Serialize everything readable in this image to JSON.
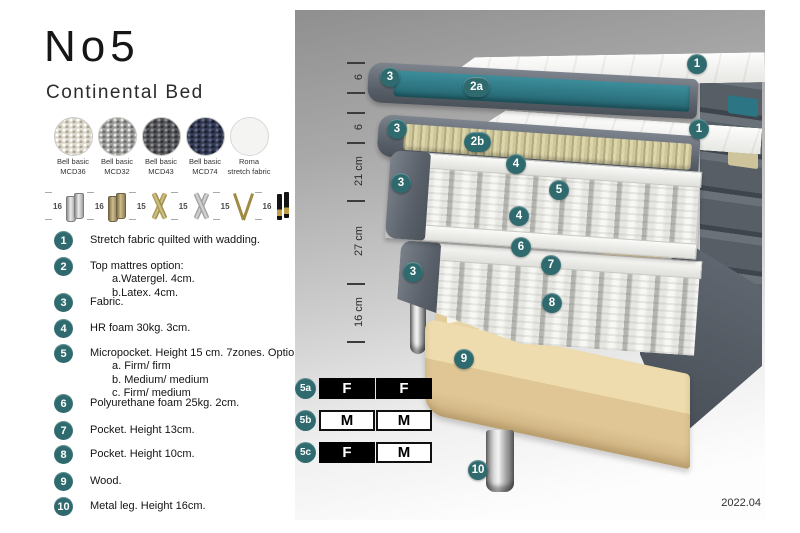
{
  "page": {
    "title": "No5",
    "subtitle": "Continental Bed",
    "version": "2022.04"
  },
  "colors": {
    "accent_teal": "#2e6a6e",
    "watergel_teal": "#2f7f8e",
    "fabric_gray": "#5c636c",
    "latex_beige": "#d6cfa6",
    "wood": "#e3cc9e"
  },
  "fabrics": [
    {
      "name": "Bell basic",
      "code": "MCD36"
    },
    {
      "name": "Bell basic",
      "code": "MCD32"
    },
    {
      "name": "Bell basic",
      "code": "MCD43"
    },
    {
      "name": "Bell basic",
      "code": "MCD74"
    },
    {
      "name": "Roma",
      "code": "stretch fabric"
    }
  ],
  "legs": [
    {
      "height": "16"
    },
    {
      "height": "16"
    },
    {
      "height": "15"
    },
    {
      "height": "15"
    },
    {
      "height": "15"
    },
    {
      "height": "16"
    }
  ],
  "features": [
    {
      "num": "1",
      "text": "Stretch fabric quilted with wadding."
    },
    {
      "num": "2",
      "text": "Top mattres option:",
      "subs": [
        "a.Watergel. 4cm.",
        "b.Latex. 4cm."
      ]
    },
    {
      "num": "3",
      "text": "Fabric."
    },
    {
      "num": "4",
      "text": "HR foam 30kg. 3cm."
    },
    {
      "num": "5",
      "text": "Micropocket. Height 15 cm. 7zones. Option:",
      "subs": [
        "a. Firm/ firm",
        "b. Medium/ medium",
        "c. Firm/ medium"
      ]
    },
    {
      "num": "6",
      "text": "Polyurethane foam 25kg. 2cm."
    },
    {
      "num": "7",
      "text": "Pocket. Height 13cm."
    },
    {
      "num": "8",
      "text": "Pocket. Height 10cm."
    },
    {
      "num": "9",
      "text": "Wood."
    },
    {
      "num": "10",
      "text": "Metal leg. Height 16cm."
    }
  ],
  "diagram": {
    "measurements": [
      "6",
      "6",
      "21 cm",
      "27 cm",
      "16 cm"
    ],
    "badges": {
      "n1": "1",
      "n2a": "2a",
      "n2b": "2b",
      "n3": "3",
      "n4": "4",
      "n5": "5",
      "n6": "6",
      "n7": "7",
      "n8": "8",
      "n9": "9",
      "n10": "10"
    },
    "firmness": [
      {
        "badge": "5a",
        "cells": [
          "F",
          "F"
        ]
      },
      {
        "badge": "5b",
        "cells": [
          "M",
          "M"
        ]
      },
      {
        "badge": "5c",
        "cells": [
          "F",
          "M"
        ]
      }
    ]
  }
}
